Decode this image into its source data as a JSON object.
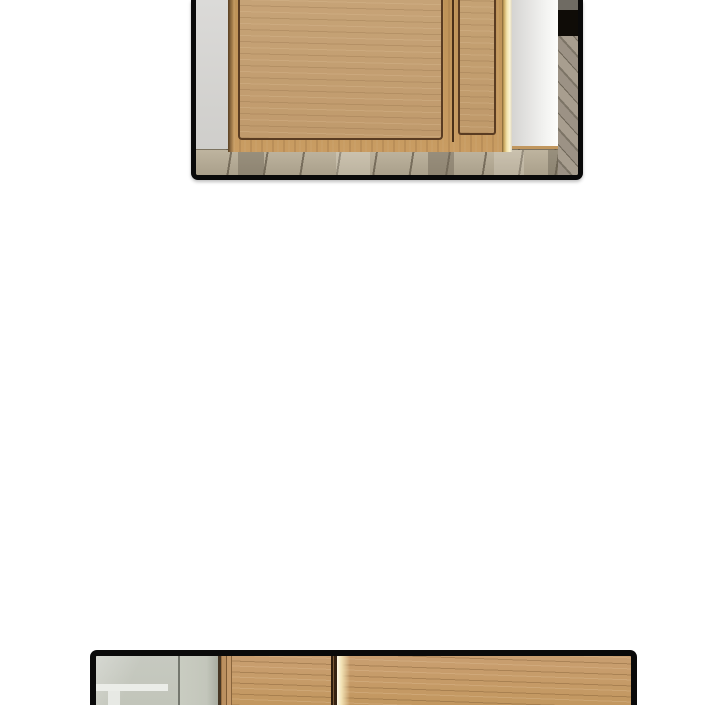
{
  "page": {
    "type": "webtoon-comic-page",
    "background_color": "#ffffff",
    "panel_border_color": "#0a0a0a"
  },
  "panels": [
    {
      "name": "door-scene-panel",
      "position": "top",
      "description": "Close-up of the lower half of a light wooden front door with recessed panels, a bright light seam along its right edge, a light gray wall on the left, a white wall column and dark hallway opening on the right, and a plank wood floor below. Panel is cropped at the top of the page.",
      "colors": {
        "door_wood": "#c1975f",
        "door_inner_panel": "#c4a074",
        "panel_inset_line": "#5a3c22",
        "light_gap": "#f3e3ac",
        "wall_left": "#d6d5d3",
        "wall_right": "#f2f2f0",
        "hallway_dark": "#0f0c07",
        "floor": "#b3a994"
      }
    },
    {
      "name": "cabinet-scene-panel",
      "position": "bottom",
      "description": "Top sliver of a panel showing wooden cabinet or door fronts with a dark seam and a bright cream light seam, next to a greenish-gray wall with a white furniture edge on the left. Panel is cropped at the bottom of the page.",
      "colors": {
        "wood": "#c59b6d",
        "seam_dark": "#352212",
        "light_seam": "#f2e2b4",
        "wall": "#c3c6bb",
        "white_trim": "#ebede8"
      }
    }
  ]
}
